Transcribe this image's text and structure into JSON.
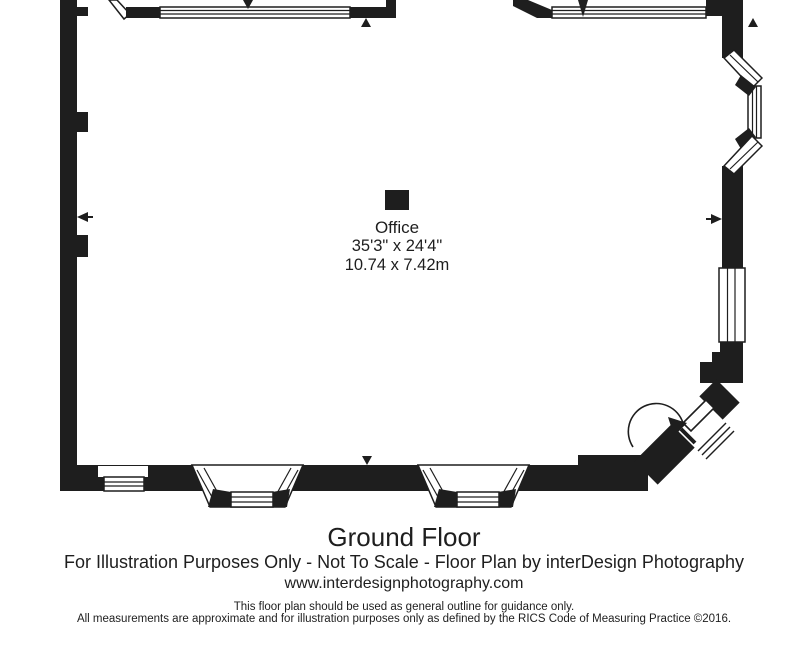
{
  "floor_plan": {
    "room": {
      "name": "Office",
      "dimensions_imperial": "35'3\" x 24'4\"",
      "dimensions_metric": "10.74 x 7.42m"
    },
    "title": "Ground Floor",
    "credit_line": "For Illustration Purposes Only - Not To Scale - Floor Plan by interDesign Photography",
    "website": "www.interdesignphotography.com",
    "disclaimer": [
      "This floor plan should be used as general outline for guidance only.",
      "All measurements are approximate and for illustration purposes only as defined by the RICS Code of Measuring Practice ©2016."
    ],
    "colors": {
      "ink": "#1e1e1e",
      "background": "#ffffff"
    }
  }
}
